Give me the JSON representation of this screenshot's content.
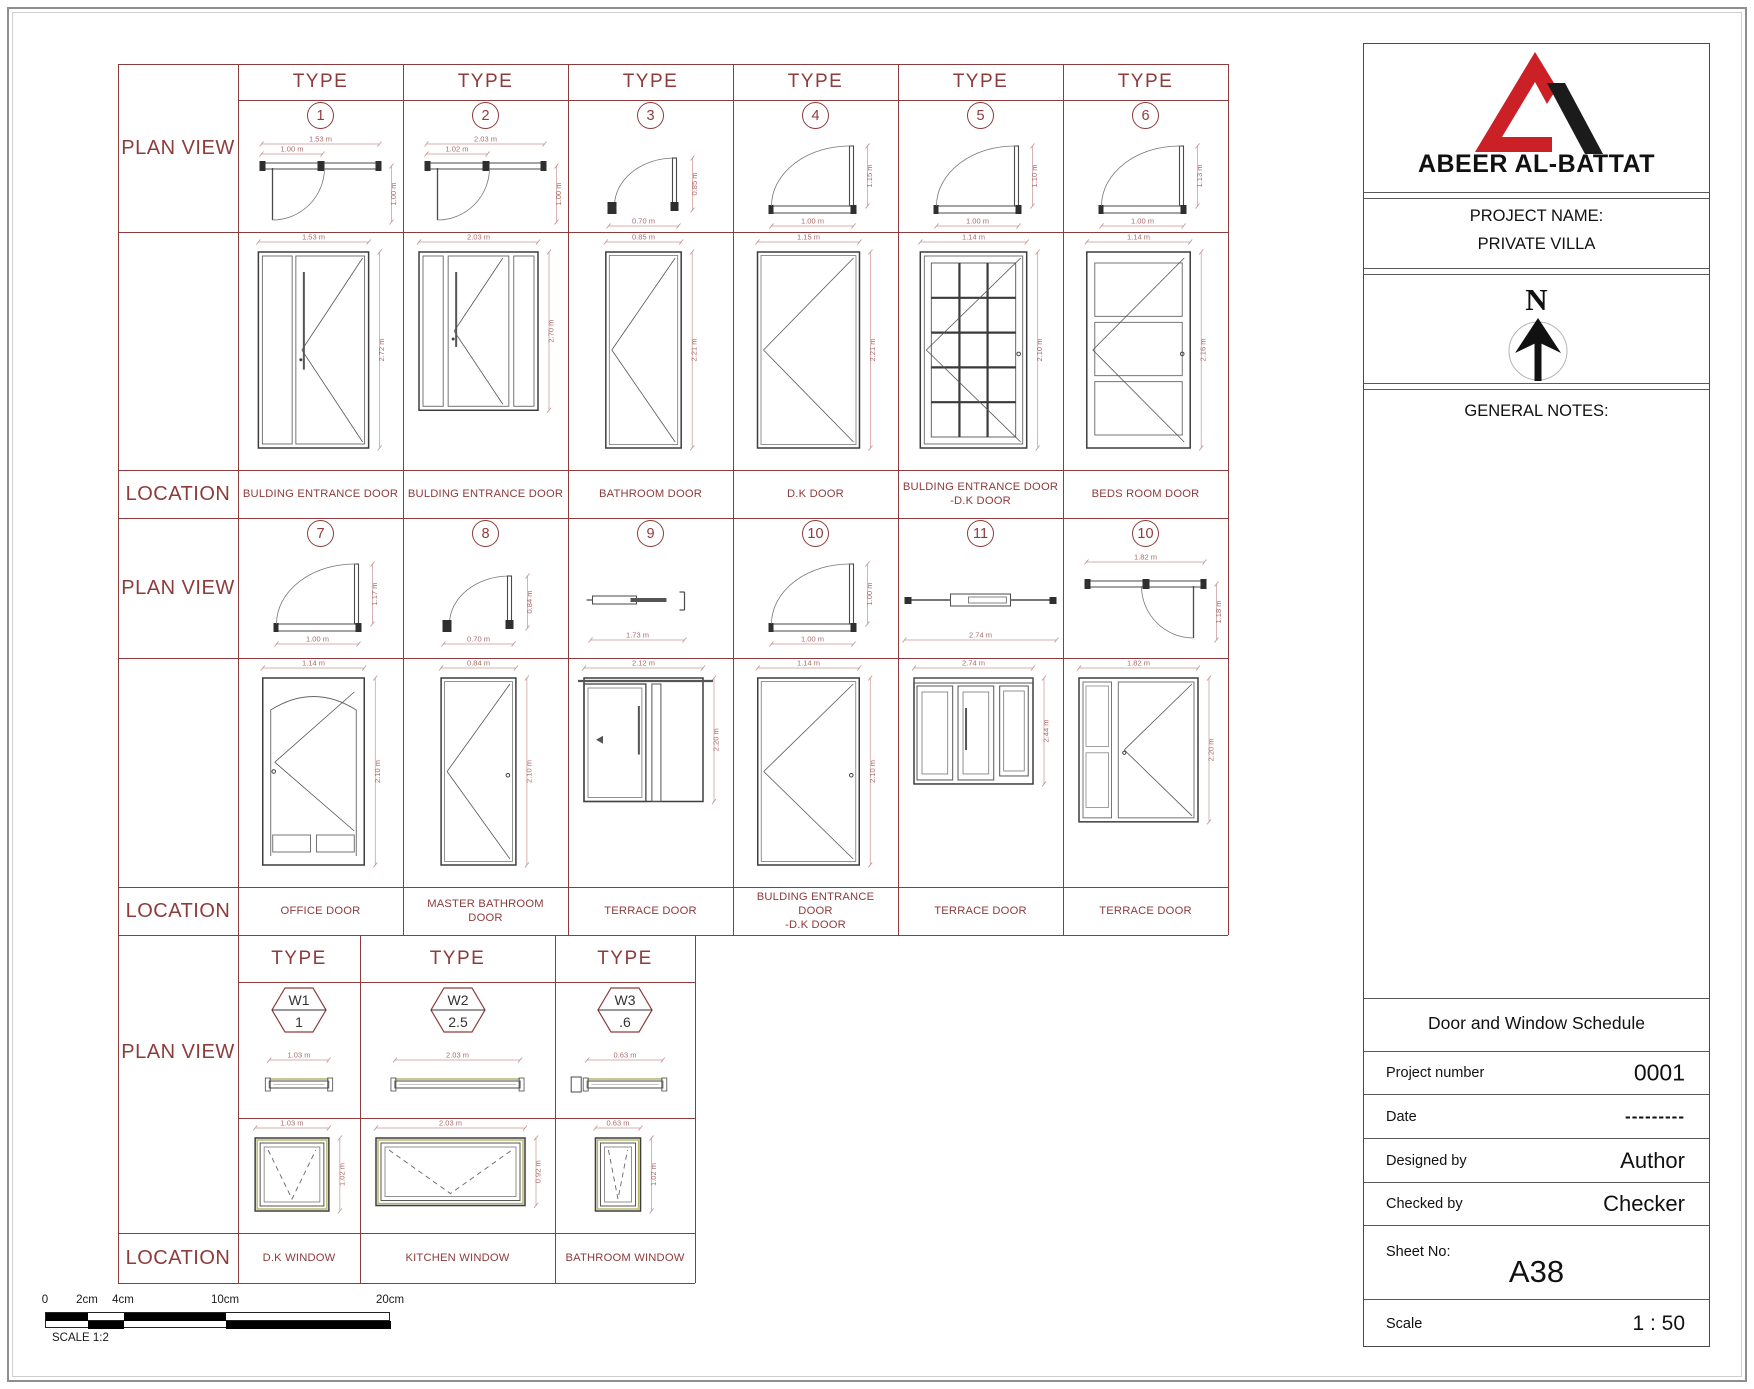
{
  "table": {
    "row_labels": {
      "type": "TYPE",
      "plan_view": "PLAN VIEW",
      "location": "LOCATION"
    },
    "door_sections": [
      {
        "columns": [
          {
            "type_no": "1",
            "location": "BULDING ENTRANCE DOOR",
            "plan": {
              "kind": "entry-swing",
              "top1": "1.53 m",
              "top2": "1.00 m",
              "side": "1.00 m"
            },
            "elev": {
              "kind": "entrance-1",
              "wm": 1.53,
              "hm": 2.72,
              "top": "1.53 m",
              "side": "2.72 m"
            }
          },
          {
            "type_no": "2",
            "location": "BULDING ENTRANCE DOOR",
            "plan": {
              "kind": "entry-swing",
              "top1": "2.03 m",
              "top2": "1.02 m",
              "side": "1.00 m"
            },
            "elev": {
              "kind": "entrance-2",
              "wm": 2.03,
              "hm": 2.7,
              "top": "2.03 m",
              "side": "2.70 m"
            }
          },
          {
            "type_no": "3",
            "location": "BATHROOM DOOR",
            "plan": {
              "kind": "small-swing",
              "bottom": "0.70 m",
              "side": "0.85 m"
            },
            "elev": {
              "kind": "plain",
              "wm": 0.85,
              "hm": 2.21,
              "top": "0.85 m",
              "side": "2.21 m"
            }
          },
          {
            "type_no": "4",
            "location": "D.K DOOR",
            "plan": {
              "kind": "quarter-swing",
              "bottom": "1.00 m",
              "side": "1.15 m"
            },
            "elev": {
              "kind": "plain",
              "wm": 1.15,
              "hm": 2.21,
              "top": "1.15 m",
              "side": "2.21 m"
            }
          },
          {
            "type_no": "5",
            "location": "BULDING ENTRANCE DOOR\n-D.K DOOR",
            "plan": {
              "kind": "quarter-swing",
              "bottom": "1.00 m",
              "side": "1.10 m"
            },
            "elev": {
              "kind": "grid",
              "knob": true,
              "wm": 1.14,
              "hm": 2.1,
              "top": "1.14 m",
              "side": "2.10 m"
            }
          },
          {
            "type_no": "6",
            "location": "BEDS ROOM DOOR",
            "plan": {
              "kind": "quarter-swing",
              "bottom": "1.00 m",
              "side": "1.13 m"
            },
            "elev": {
              "kind": "three-panel",
              "knob": true,
              "wm": 1.14,
              "hm": 2.16,
              "top": "1.14 m",
              "side": "2.16 m"
            }
          }
        ]
      },
      {
        "columns": [
          {
            "type_no": "7",
            "location": "OFFICE DOOR",
            "plan": {
              "kind": "quarter-swing",
              "bottom": "1.00 m",
              "side": "1.17 m"
            },
            "elev": {
              "kind": "office",
              "wm": 1.14,
              "hm": 2.1,
              "top": "1.14 m",
              "side": "2.10 m"
            }
          },
          {
            "type_no": "8",
            "location": "MASTER BATHROOM\nDOOR",
            "plan": {
              "kind": "small-swing",
              "bottom": "0.70 m",
              "side": "0.84 m"
            },
            "elev": {
              "kind": "plain",
              "knob": true,
              "wm": 0.84,
              "hm": 2.1,
              "top": "0.84 m",
              "side": "2.10 m"
            }
          },
          {
            "type_no": "9",
            "location": "TERRACE DOOR",
            "plan": {
              "kind": "sliding-small",
              "bottom": "1.73 m"
            },
            "elev": {
              "kind": "slider",
              "wm": 2.12,
              "hm": 2.2,
              "top": "2.12 m",
              "side": "2.20 m"
            }
          },
          {
            "type_no": "10",
            "location": "BULDING ENTRANCE\nDOOR\n-D.K DOOR",
            "plan": {
              "kind": "quarter-swing",
              "bottom": "1.00 m",
              "side": "1.00 m"
            },
            "elev": {
              "kind": "plain",
              "knob": true,
              "wm": 1.14,
              "hm": 2.1,
              "top": "1.14 m",
              "side": "2.10 m"
            }
          },
          {
            "type_no": "11",
            "location": "TERRACE DOOR",
            "plan": {
              "kind": "sliding-wide",
              "bottom": "2.74 m"
            },
            "elev": {
              "kind": "three-slide",
              "wm": 2.74,
              "hm": 2.44,
              "top": "2.74 m",
              "side": "2.44 m"
            }
          },
          {
            "type_no": "10",
            "location": "TERRACE DOOR",
            "plan": {
              "kind": "entry-swing-mirror",
              "top1": "1.82 m",
              "side": "1.18 m"
            },
            "elev": {
              "kind": "door-sidelite",
              "wm": 1.82,
              "hm": 2.2,
              "top": "1.82 m",
              "side": "2.20 m"
            }
          }
        ]
      }
    ],
    "window_section": {
      "columns": [
        {
          "tag": "W1",
          "tag_sub": "1",
          "location": "D.K WINDOW",
          "plan": {
            "kind": "window-strip",
            "top": "1.03 m"
          },
          "elev": {
            "kind": "window",
            "wm": 1.03,
            "hm": 1.02,
            "top": "1.03 m",
            "side": "1.02 m"
          }
        },
        {
          "tag": "W2",
          "tag_sub": "2.5",
          "location": "KITCHEN WINDOW",
          "plan": {
            "kind": "window-strip",
            "top": "2.03 m"
          },
          "elev": {
            "kind": "window",
            "wm": 2.03,
            "hm": 0.92,
            "top": "2.03 m",
            "side": "0.92 m"
          }
        },
        {
          "tag": "W3",
          "tag_sub": ".6",
          "location": "BATHROOM WINDOW",
          "plan": {
            "kind": "window-strip",
            "block": true,
            "top": "0.63 m"
          },
          "elev": {
            "kind": "window",
            "wm": 0.63,
            "hm": 1.02,
            "top": "0.63 m",
            "side": "1.02 m"
          }
        }
      ]
    }
  },
  "scale_bar": {
    "ticks": [
      "0",
      "2cm",
      "4cm",
      "10cm",
      "20cm"
    ],
    "caption": "SCALE 1:2"
  },
  "title_block": {
    "brand": "ABEER AL-BATTAT",
    "project_label": "PROJECT NAME:",
    "project_name": "PRIVATE VILLA",
    "north_letter": "N",
    "notes_label": "GENERAL NOTES:",
    "sheet_title": "Door and Window Schedule",
    "fields": [
      {
        "label": "Project number",
        "value": "0001"
      },
      {
        "label": "Date",
        "value": "---------"
      },
      {
        "label": "Designed by",
        "value": "Author"
      },
      {
        "label": "Checked by",
        "value": "Checker"
      }
    ],
    "sheet_no_label": "Sheet No:",
    "sheet_no": "A38",
    "scale_label": "Scale",
    "scale_value": "1 : 50"
  },
  "colors": {
    "grid": "#8d3b3b",
    "logo_red": "#cb2026",
    "logo_black": "#1b1b1b",
    "window_accent": "#b5b56a"
  }
}
